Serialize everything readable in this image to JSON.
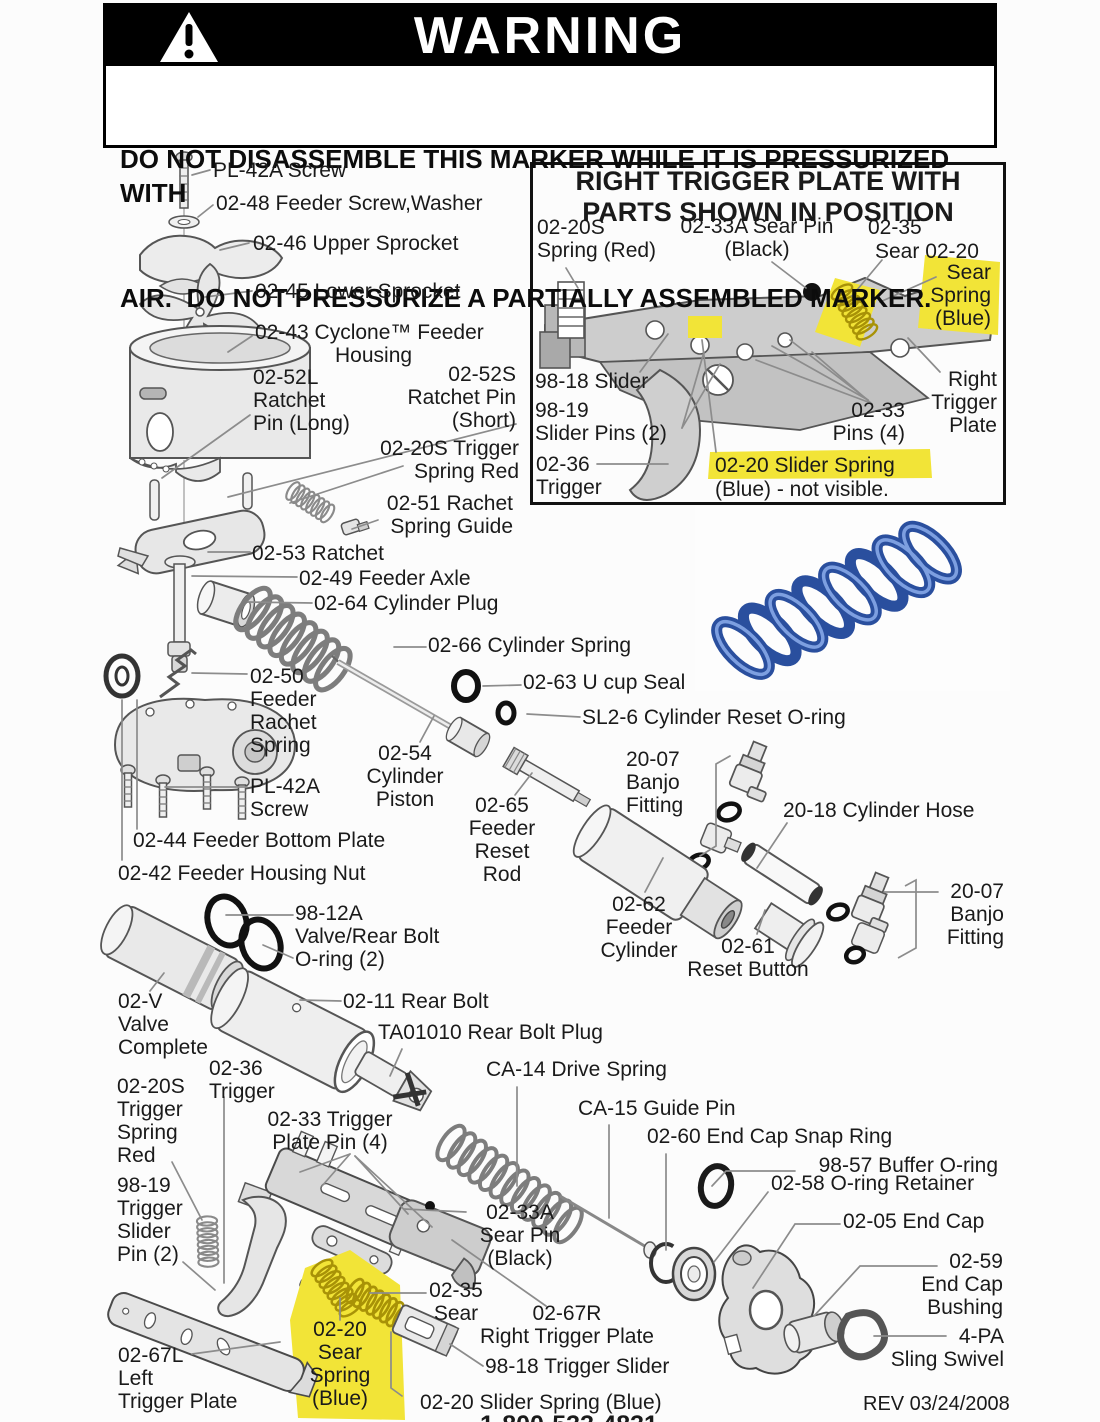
{
  "colors": {
    "highlight": "#f2e437",
    "spring_blue": "#2a4f9e",
    "ink": "#1a1a1a"
  },
  "warning": {
    "title": "WARNING",
    "line1": "DO NOT DISASSEMBLE THIS MARKER WHILE IT IS PRESSURIZED WITH",
    "line2": "AIR.  DO NOT PRESSURIZE A PARTIALLY ASSEMBLED MARKER."
  },
  "inset": {
    "title_line1": "RIGHT TRIGGER PLATE WITH",
    "title_line2": "PARTS SHOWN IN POSITION"
  },
  "footer": {
    "rev": "REV 03/24/2008",
    "phone_partial": "1-800-533-4831"
  },
  "labels": [
    {
      "t": "PL-42A Screw",
      "x": 213,
      "y": 159
    },
    {
      "t": "02-48 Feeder Screw,Washer",
      "x": 216,
      "y": 192
    },
    {
      "t": "02-46 Upper Sprocket",
      "x": 253,
      "y": 232
    },
    {
      "t": "02-45 Lower Sprocket",
      "x": 255,
      "y": 280
    },
    {
      "t": "02-43 Cyclone™ Feeder",
      "x": 255,
      "y": 321
    },
    {
      "t": "Housing",
      "x": 335,
      "y": 344
    },
    {
      "t": "02-52L\nRatchet\nPin (Long)",
      "x": 253,
      "y": 366
    },
    {
      "t": "02-52S\nRatchet Pin\n(Short)",
      "x": 516,
      "y": 363,
      "a": "right"
    },
    {
      "t": "02-20S Trigger\nSpring Red",
      "x": 519,
      "y": 437,
      "a": "right"
    },
    {
      "t": "02-51 Rachet\nSpring Guide",
      "x": 513,
      "y": 492,
      "a": "right"
    },
    {
      "t": "02-53 Ratchet",
      "x": 252,
      "y": 542
    },
    {
      "t": "02-49 Feeder Axle",
      "x": 299,
      "y": 567
    },
    {
      "t": "02-64 Cylinder Plug",
      "x": 314,
      "y": 592
    },
    {
      "t": "02-66 Cylinder Spring",
      "x": 428,
      "y": 634
    },
    {
      "t": "02-50\nFeeder\nRachet\nSpring",
      "x": 250,
      "y": 665
    },
    {
      "t": "PL-42A\nScrew",
      "x": 250,
      "y": 775
    },
    {
      "t": "02-44 Feeder Bottom Plate",
      "x": 133,
      "y": 829
    },
    {
      "t": "02-42 Feeder Housing Nut",
      "x": 118,
      "y": 862
    },
    {
      "t": "02-54\nCylinder\nPiston",
      "x": 405,
      "y": 742,
      "a": "center"
    },
    {
      "t": "02-65\nFeeder\nReset\nRod",
      "x": 502,
      "y": 794,
      "a": "center"
    },
    {
      "t": "02-63 U cup Seal",
      "x": 523,
      "y": 671
    },
    {
      "t": "SL2-6 Cylinder Reset O-ring",
      "x": 582,
      "y": 706
    },
    {
      "t": "20-07\nBanjo\nFitting",
      "x": 626,
      "y": 748
    },
    {
      "t": "20-18 Cylinder Hose",
      "x": 783,
      "y": 799
    },
    {
      "t": "02-62\nFeeder\nCylinder",
      "x": 639,
      "y": 893,
      "a": "center"
    },
    {
      "t": "02-61\nReset Button",
      "x": 748,
      "y": 935,
      "a": "center"
    },
    {
      "t": "20-07\nBanjo\nFitting",
      "x": 1004,
      "y": 880,
      "a": "right"
    },
    {
      "t": "98-12A\nValve/Rear Bolt\nO-ring (2)",
      "x": 295,
      "y": 902
    },
    {
      "t": "02-V\nValve\nComplete",
      "x": 118,
      "y": 990
    },
    {
      "t": "02-11 Rear Bolt",
      "x": 343,
      "y": 990
    },
    {
      "t": "TA01010 Rear Bolt Plug",
      "x": 378,
      "y": 1021
    },
    {
      "t": "CA-14 Drive Spring",
      "x": 486,
      "y": 1058
    },
    {
      "t": "CA-15 Guide Pin",
      "x": 578,
      "y": 1097
    },
    {
      "t": "02-60 End Cap Snap Ring",
      "x": 647,
      "y": 1125
    },
    {
      "t": "98-57 Buffer O-ring",
      "x": 998,
      "y": 1154,
      "a": "right"
    },
    {
      "t": "02-58 O-ring Retainer",
      "x": 771,
      "y": 1172
    },
    {
      "t": "02-05 End Cap",
      "x": 843,
      "y": 1210
    },
    {
      "t": "02-59\nEnd Cap\nBushing",
      "x": 1003,
      "y": 1250,
      "a": "right"
    },
    {
      "t": "4-PA\nSling Swivel",
      "x": 1004,
      "y": 1325,
      "a": "right"
    },
    {
      "t": "02-20S\nTrigger\nSpring\nRed",
      "x": 117,
      "y": 1075
    },
    {
      "t": "02-36\nTrigger",
      "x": 209,
      "y": 1057
    },
    {
      "t": "02-33 Trigger\nPlate Pin (4)",
      "x": 330,
      "y": 1108,
      "a": "center"
    },
    {
      "t": "98-19\nTrigger\nSlider\nPin (2)",
      "x": 117,
      "y": 1174
    },
    {
      "t": "02-33A\nSear Pin\n(Black)",
      "x": 520,
      "y": 1201,
      "a": "center"
    },
    {
      "t": "02-35\nSear",
      "x": 456,
      "y": 1279,
      "a": "center"
    },
    {
      "t": "02-67R\nRight Trigger Plate",
      "x": 567,
      "y": 1302,
      "a": "center"
    },
    {
      "t": "98-18 Trigger Slider",
      "x": 485,
      "y": 1355
    },
    {
      "t": "02-20 Slider Spring (Blue)",
      "x": 420,
      "y": 1391
    },
    {
      "t": "02-67L\nLeft\nTrigger Plate",
      "x": 118,
      "y": 1344
    },
    {
      "t": "02-20\nSear\nSpring\n(Blue)",
      "x": 340,
      "y": 1318,
      "a": "center",
      "hl": true
    },
    {
      "t": "REV 03/24/2008",
      "x": 863,
      "y": 1393,
      "fs": 20
    },
    {
      "t": "1-800-533-4831",
      "x": 480,
      "y": 1412,
      "fs": 25,
      "b": true
    },
    {
      "t": "02-20S\nSpring (Red)",
      "x": 537,
      "y": 216
    },
    {
      "t": "02-33A Sear Pin\n(Black)",
      "x": 757,
      "y": 215,
      "a": "center"
    },
    {
      "t": "02-35",
      "x": 868,
      "y": 216
    },
    {
      "t": "Sear 02-20",
      "x": 875,
      "y": 240
    },
    {
      "t": "Sear\nSpring\n(Blue)",
      "x": 991,
      "y": 261,
      "a": "right",
      "hl": true
    },
    {
      "t": "98-18 Slider",
      "x": 535,
      "y": 370
    },
    {
      "t": "98-19\nSlider Pins (2)",
      "x": 535,
      "y": 399
    },
    {
      "t": "02-36\nTrigger",
      "x": 536,
      "y": 453
    },
    {
      "t": "02-33\nPins (4)",
      "x": 905,
      "y": 399,
      "a": "right"
    },
    {
      "t": "Right\nTrigger\nPlate",
      "x": 997,
      "y": 368,
      "a": "right"
    },
    {
      "t": "02-20 Slider Spring",
      "x": 715,
      "y": 454,
      "hl": true
    },
    {
      "t": "(Blue) - not visible.",
      "x": 715,
      "y": 478
    }
  ]
}
